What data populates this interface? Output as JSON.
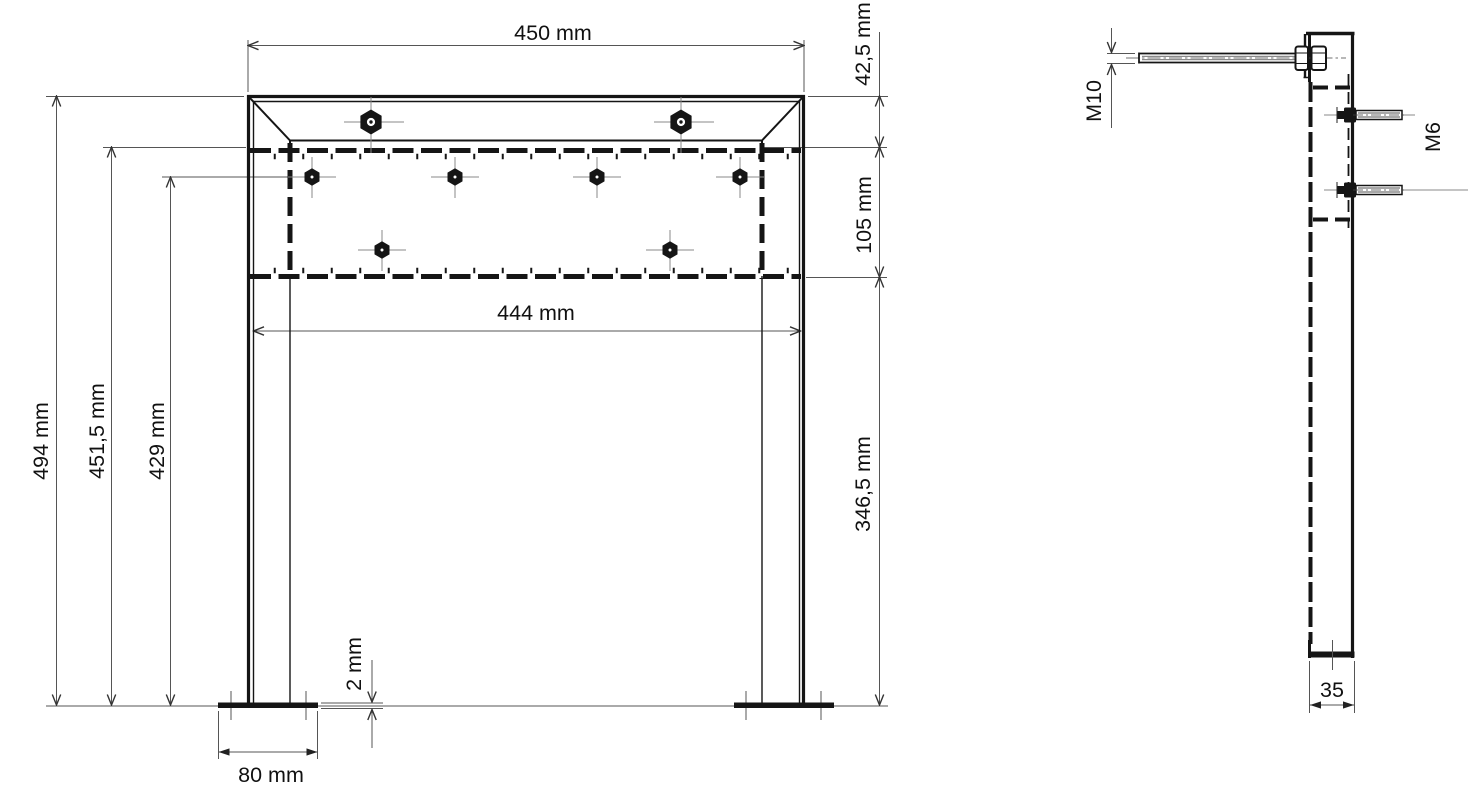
{
  "drawing": {
    "type": "technical-drawing",
    "subject": "sign stand frame, front and side view",
    "background_color": "#ffffff",
    "ink_color": "#151515",
    "dim_line_color": "#555555"
  },
  "labels": {
    "width_overall": "450 mm",
    "channel_height": "42,5 mm",
    "plate_height": "105 mm",
    "leg_clear_height": "346,5 mm",
    "height_overall": "494 mm",
    "height_to_plate": "451,5 mm",
    "height_to_bolt_row": "429 mm",
    "inner_width": "444 mm",
    "foot_plate_thickness": "2 mm",
    "foot_plate_width": "80 mm",
    "top_bolt_thread": "M10",
    "side_bolt_thread": "M6",
    "profile_depth": "35"
  }
}
